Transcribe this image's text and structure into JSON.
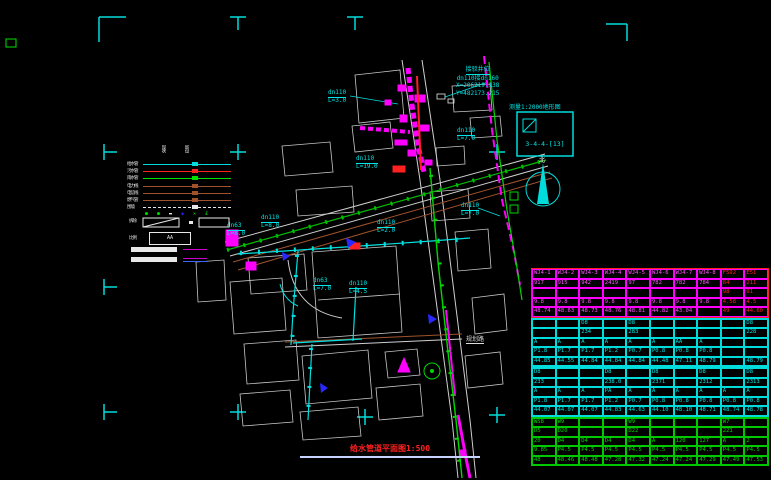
{
  "title": {
    "text": "给水管道平面图1:500"
  },
  "scale_box": {
    "label": "测量1:2000地形图",
    "sheet_no": "3-4-4-[13]"
  },
  "north": {
    "label": "北"
  },
  "annotation": {
    "line1": "接驳井位",
    "line2": "dn110接dn160",
    "line3": "X=206219.138",
    "line4": "Y=482173.215"
  },
  "legend": {
    "col_headers": [
      "现状",
      "新设"
    ],
    "rows": [
      {
        "label": "给水管",
        "color": "#00dcdc",
        "style": "solid"
      },
      {
        "label": "污水管",
        "color": "#ff2020",
        "style": "solid"
      },
      {
        "label": "雨水管",
        "color": "#00e000",
        "style": "solid"
      },
      {
        "label": "电力线",
        "color": "#a0522d",
        "style": "solid"
      },
      {
        "label": "电信线",
        "color": "#a0522d",
        "style": "solid"
      },
      {
        "label": "燃气管",
        "color": "#a0522d",
        "style": "solid"
      },
      {
        "label": "围墙",
        "color": "#e8e8e8",
        "style": "dashed"
      }
    ],
    "symbols": [
      {
        "glyph": "●",
        "color": "#00e000"
      },
      {
        "glyph": "●",
        "color": "#00e000"
      },
      {
        "glyph": "▬",
        "color": "#e8e8e8"
      },
      {
        "glyph": "◆",
        "color": "#2828ff"
      },
      {
        "glyph": "✕",
        "color": "#00e000"
      },
      {
        "glyph": "£",
        "color": "#00e000"
      }
    ],
    "demolish_label": "拆除",
    "equals_label": "=",
    "new_label": "比例",
    "aa_label": "AA"
  },
  "map_labels": [
    {
      "text": "dn110",
      "sub": "L=3.0",
      "x": 328,
      "y": 90,
      "c": "cyan"
    },
    {
      "text": "dn110",
      "sub": "L=7.0",
      "x": 457,
      "y": 128,
      "c": "cyan"
    },
    {
      "text": "dn110",
      "sub": "L=19.0",
      "x": 356,
      "y": 156,
      "c": "cyan"
    },
    {
      "text": "dn110",
      "sub": "L=7.0",
      "x": 461,
      "y": 203,
      "c": "cyan"
    },
    {
      "text": "dn110",
      "sub": "L=8.0",
      "x": 261,
      "y": 215,
      "c": "cyan"
    },
    {
      "text": "dn63",
      "sub": "L=8.0",
      "x": 227,
      "y": 223,
      "c": "cyan"
    },
    {
      "text": "dn110",
      "sub": "L=2.0",
      "x": 377,
      "y": 220,
      "c": "cyan"
    },
    {
      "text": "dn63",
      "sub": "L=7.0",
      "x": 313,
      "y": 278,
      "c": "cyan"
    },
    {
      "text": "dn110",
      "sub": "L=4.5",
      "x": 349,
      "y": 281,
      "c": "cyan"
    },
    {
      "text": "规划路",
      "x": 466,
      "y": 337,
      "c": "white"
    }
  ],
  "table": {
    "groups": [
      {
        "border": "#ff2020",
        "grid": "#ff00ff",
        "text": "#ff50ff",
        "red": "#ff2020",
        "red_cols": [
          8,
          9
        ],
        "rows": [
          [
            "WJ4-1",
            "WJ4-2",
            "WJ4-3",
            "WJ4-4",
            "WJ4-5",
            "WJ4-6",
            "WJ4-7",
            "WJ4-8",
            "F592",
            "E51"
          ],
          [
            "917",
            "915",
            "942",
            "2419",
            "97",
            "782",
            "782",
            "784",
            "84",
            "211"
          ],
          [
            "",
            "",
            "",
            "",
            "",
            "",
            "",
            "",
            "98",
            "91"
          ],
          [
            "9.8",
            "9.8",
            "9.8",
            "9.8",
            "9.8",
            "9.8",
            "9.8",
            "9.8",
            "4.58",
            "4.5"
          ],
          [
            "48.74",
            "48.63",
            "48.73",
            "48.76",
            "48.81",
            "44.82",
            "43.04",
            "",
            "49",
            "44.60"
          ]
        ]
      },
      {
        "border": "#00dcdc",
        "grid": "#00dcdc",
        "text": "#00e5e5",
        "rows": [
          [
            "",
            "",
            "D8",
            "",
            "D8",
            "",
            "",
            "",
            "",
            "D8"
          ],
          [
            "",
            "",
            "234",
            "",
            "283",
            "",
            "",
            "",
            "",
            "228"
          ],
          [
            "A",
            "A",
            "A",
            "A",
            "A",
            "A",
            "AA",
            "A",
            "",
            ""
          ],
          [
            "P1.8",
            "P1.7",
            "P1.7",
            "P1.2",
            "P0.7",
            "P0.8",
            "P0.8",
            "P0.8",
            "",
            ""
          ],
          [
            "44.85",
            "44.55",
            "44.84",
            "44.84",
            "44.84",
            "44.48",
            "47.11",
            "48.79",
            "",
            "48.79"
          ]
        ]
      },
      {
        "border": "#00dcdc",
        "grid": "#00dcdc",
        "text": "#00e5e5",
        "rows": [
          [
            "D8",
            "",
            "",
            "D8",
            "",
            "D8",
            "",
            "D8",
            "",
            "D8"
          ],
          [
            "233",
            "",
            "",
            "238.0",
            "",
            "2371",
            "",
            "2312",
            "",
            "2313"
          ],
          [
            "A",
            "A",
            "A",
            "PA",
            "A",
            "A",
            "A",
            "A",
            "A",
            "A"
          ],
          [
            "P1.8",
            "P1.7",
            "P1.7",
            "P1.2",
            "P0.7",
            "P0.8",
            "P0.8",
            "P0.8",
            "P0.8",
            "P0.8"
          ],
          [
            "44.07",
            "44.07",
            "44.07",
            "44.83",
            "44.63",
            "44.10",
            "48.10",
            "48.71",
            "48.74",
            "48.78"
          ]
        ]
      },
      {
        "border": "#00c800",
        "grid": "#00c800",
        "text": "#00d800",
        "rows": [
          [
            "WS8",
            "W9",
            "",
            "",
            "W9",
            "",
            "",
            "",
            "W7",
            ""
          ],
          [
            "D5",
            "D20",
            "",
            "",
            "D22",
            "",
            "",
            "",
            "221",
            ""
          ],
          [
            "20",
            "D4",
            "D4",
            "D4",
            "D4",
            "A",
            "120",
            "127",
            "A",
            "2"
          ],
          [
            "9.85",
            "P4.5",
            "P4.5",
            "P4.5",
            "P4.5",
            "P4.5",
            "P4.5",
            "P4.5",
            "P4.5",
            "P4.5"
          ],
          [
            "48",
            "48.46",
            "48.48",
            "47.28",
            "47.32",
            "47.24",
            "47.24",
            "47.29",
            "47.49",
            "47.53"
          ]
        ]
      }
    ]
  }
}
